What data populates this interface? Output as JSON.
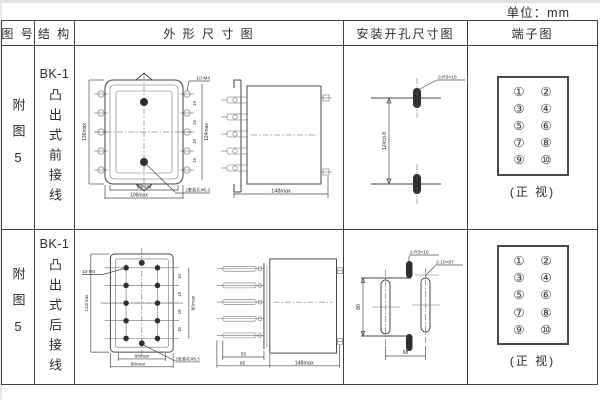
{
  "unit_label": "单位：mm",
  "header": {
    "col_figure": "图 号",
    "col_structure": "结 构",
    "col_outline": "外 形 尺 寸 图",
    "col_install": "安装开孔尺寸图",
    "col_terminal": "端子图"
  },
  "rows": [
    {
      "figure_no": "附图5",
      "model": "BK-1",
      "structure": "凸出式前接线",
      "outline": {
        "dim_height_left": "136max",
        "dim_height_right": "124max",
        "pitch": "19",
        "thread_label": "10-M4",
        "dim_width_inner": "98max",
        "dim_width_outer": "106max",
        "hole_label": "2安装孔Φ5.3",
        "dim_depth": "148max"
      },
      "install": {
        "dim_height": "124±0.8",
        "slot_label": "2-R3×10"
      },
      "terminal": {
        "numbers": [
          "①",
          "②",
          "③",
          "④",
          "⑤",
          "⑥",
          "⑦",
          "⑧",
          "⑨",
          "⑩"
        ],
        "caption": "(正 视)"
      }
    },
    {
      "figure_no": "附图5",
      "model": "BK-1",
      "structure": "凸出式后接线",
      "outline": {
        "dim_height_left": "112max",
        "dim_height_right": "80max",
        "pitch": "19",
        "thread_label": "10-M4",
        "dim_width_inner": "68max",
        "dim_width_outer": "88max",
        "hole_label": "2安装孔Φ5.3",
        "dim_terminal_len": "55",
        "dim_front_len": "65",
        "dim_depth": "148max"
      },
      "install": {
        "slot_small_label": "2-R3×10",
        "slot_long_label": "2-10×87",
        "dim_height": "80",
        "dim_width": "68"
      },
      "terminal": {
        "numbers": [
          "①",
          "②",
          "③",
          "④",
          "⑤",
          "⑥",
          "⑦",
          "⑧",
          "⑨",
          "⑩"
        ],
        "caption": "(正 视)"
      }
    }
  ]
}
